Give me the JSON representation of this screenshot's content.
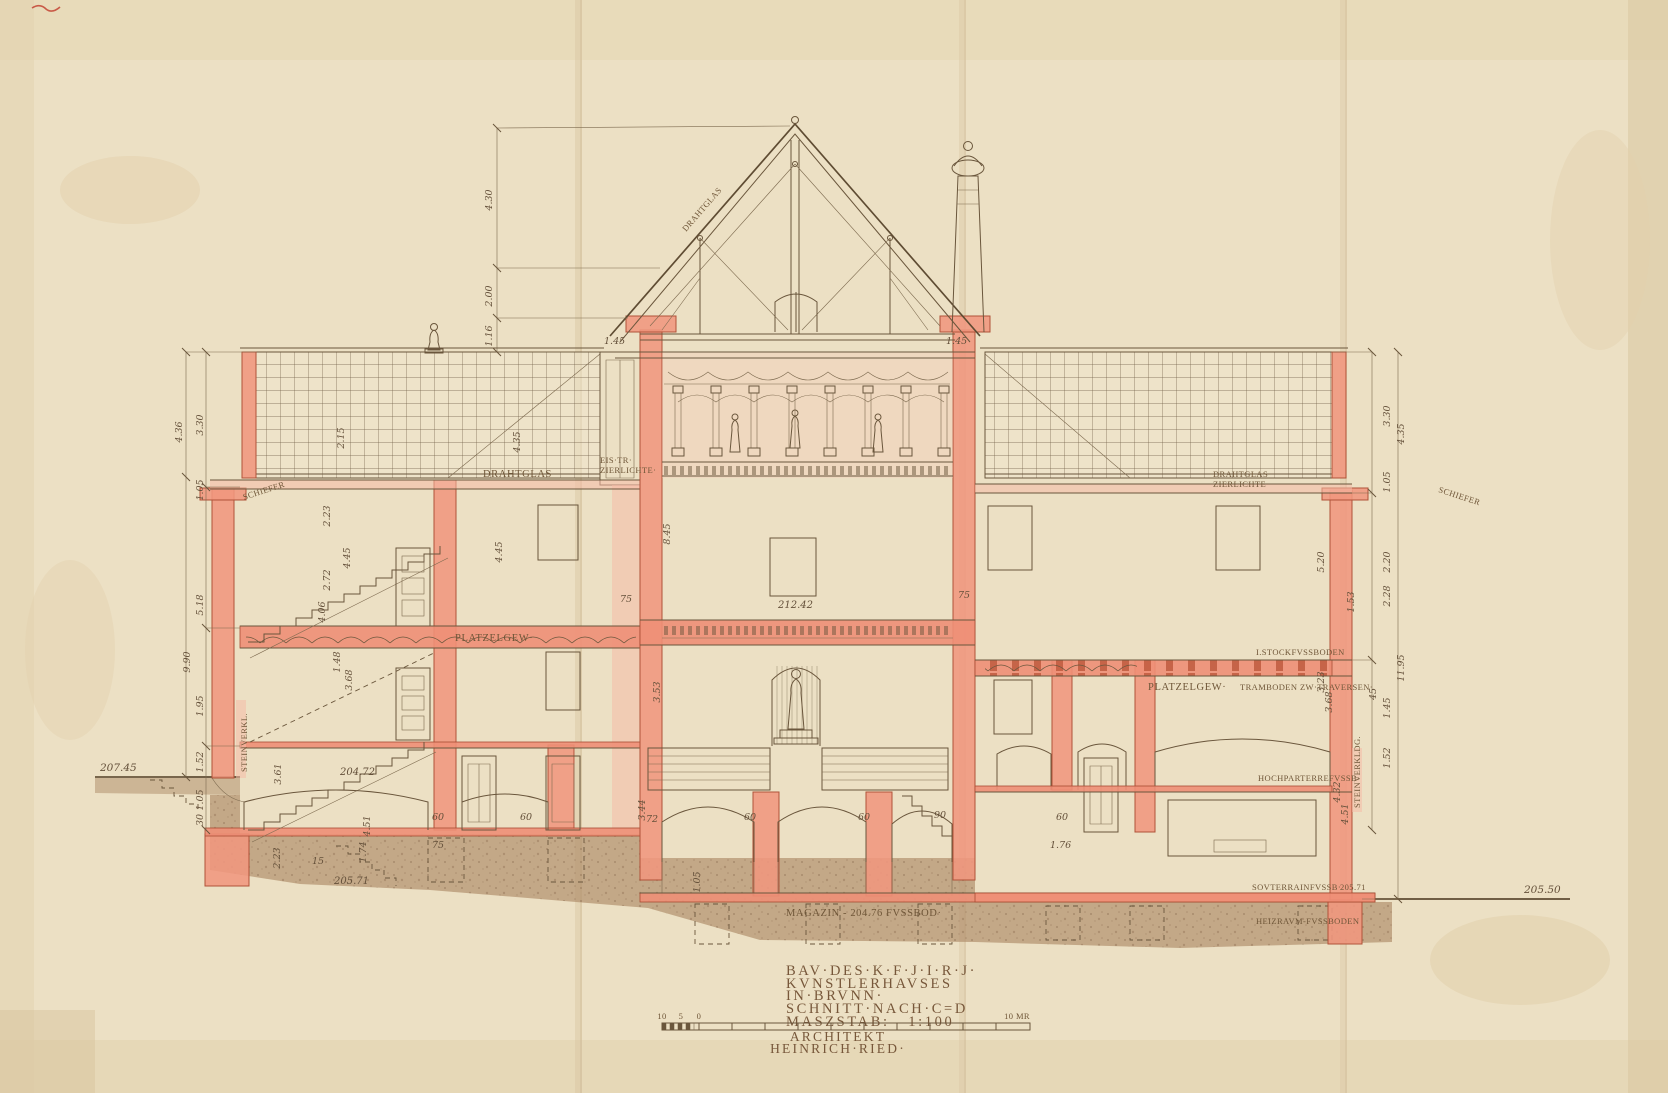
{
  "palette": {
    "paper": "#ece0c4",
    "ink": "#6a563c",
    "wall_red": "#f0967e",
    "wall_red_stroke": "#b05238",
    "ground_brown": "#b3926f",
    "lettering": "#77573a"
  },
  "title_block": {
    "line1": "BAV·DES·K·F·J·I·R·J·",
    "line2": "KVNSTLERHAVSES",
    "line3": "IN·BRVNN·",
    "line4": "SCHNITT·NACH·C=D",
    "line5": "MASZSTAB:   1:100",
    "line6": "ARCHITEKT",
    "line7": "HEINRICH·RIED·"
  },
  "scale_bar": {
    "sub10": "10",
    "sub5": "5",
    "sub0": "0",
    "end_label": "10 MR"
  },
  "labels": {
    "drahtglas_left": "DRAHTGLAS",
    "drahtglas_roof": "DRAHTGLAS",
    "drahtglas_right": "DRAHTGLAS·",
    "zierlichte_right": "ZIERLICHTE·",
    "eis_tr": "EIS·TR·",
    "zierlichte_left": "ZIERLICHTE·",
    "schiefer_left": "SCHIEFER",
    "schiefer_right": "SCHIEFER",
    "platzelgew_left": "PLATZELGEW·",
    "platzelgew_right": "PLATZELGEW·",
    "stock_fussboden": "I.STOCKFVSSBODEN",
    "tramboden": "TRAMBODEN ZW·TRAVERSEN·",
    "hochparterre": "HOCHPARTERREFVSSB·",
    "souterrain": "SOVTERRAINFVSSB·",
    "souterrain_level": "205.71",
    "heizraum": "HEIZRAVM-FVSSBODEN",
    "magazin": "MAGAZIN - 204.76 FVSSBOD·",
    "steinverkl_left": "STEINVERKL.",
    "steinverkl_right": "STEINVERKLDG."
  },
  "levels": {
    "left_terrain": "207.45",
    "stair_mid": "204.72",
    "stair_low": "205.71",
    "right_terrain": "205.50",
    "first_floor": "212.42"
  },
  "dims": {
    "t1": "4.30",
    "t2": "2.00",
    "t3": "1.16",
    "lo1": "4.36",
    "lo2": "9.90",
    "li1": "3.30",
    "li2": "1.05",
    "li3": "5.18",
    "li4": "1.95",
    "li5": "1.52",
    "li6": "1.05",
    "li7": "30",
    "ls1": "2.15",
    "ls2": "2.23",
    "ls3": "2.72",
    "ls4": "4.45",
    "ls5": "4.06",
    "ls6": "1.48",
    "ls7": "3.68",
    "ls8": "3.61",
    "ls9": "2.23",
    "ls10": "4.51",
    "ls11": "1.74",
    "ls12": "15",
    "c1": "1.45",
    "c2": "1.45",
    "c3": "8.45",
    "c4": "4.45",
    "c5": "4.35",
    "c6": "75",
    "c7": "75",
    "c8": "3.53",
    "c9": "3.44",
    "c10": "1.05",
    "b1": "60",
    "b2": "60",
    "b3": "72",
    "b4": "60",
    "b5": "60",
    "b6": "90",
    "b7": "75",
    "b8": "1.76",
    "b9": "60",
    "r1": "3.30",
    "r2": "4.35",
    "r3": "1.05",
    "r4": "2.28",
    "r5": "2.20",
    "r6": "5.20",
    "r7": "1.53",
    "r8": "11.95",
    "r9": "1.45",
    "r10": "1.52",
    "r11": "3.23",
    "r12": "3.68",
    "r13": "4.32",
    "r14": "4.51",
    "r15": "45"
  }
}
